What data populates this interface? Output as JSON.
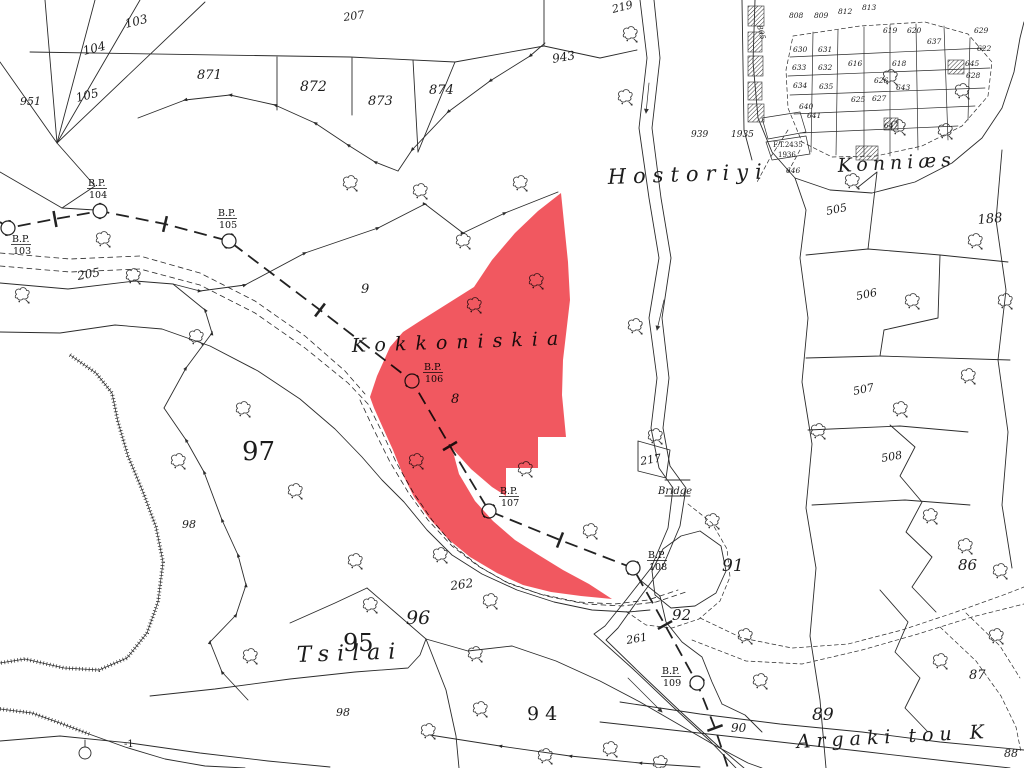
{
  "map": {
    "description": "cadastral survey map with red highlighted parcel",
    "ink_color": "#2b2b2b",
    "highlight_color": "#ef3b44",
    "highlighted_parcel": {
      "name": "Kokkoniskia highlighted parcel",
      "number": "8",
      "points": "561,193 568,262 570,300 563,360 562,395 566,437 538,437 538,468 506,468 506,496 492,487 471,469 452,448 459,474 475,501 493,521 515,540 537,554 563,570 589,584 612,599 581,596 551,592 523,585 497,573 470,557 448,539 429,518 414,497 403,475 393,450 383,428 374,408 370,397 377,376 390,347 403,332 420,321 447,304 474,287 492,260 515,233 538,211"
    },
    "labels": [
      {
        "t": "Hostoriyi",
        "x": 608,
        "y": 184,
        "s": 21,
        "ls": 7,
        "r": -2,
        "i": 1
      },
      {
        "t": "Konniæs",
        "x": 838,
        "y": 172,
        "s": 19,
        "ls": 5,
        "r": -3,
        "i": 1
      },
      {
        "t": "Kokkoniskia",
        "x": 352,
        "y": 352,
        "s": 19,
        "ls": 9,
        "r": -2,
        "i": 1
      },
      {
        "t": "Tsilai",
        "x": 297,
        "y": 662,
        "s": 22,
        "ls": 8,
        "r": -2,
        "i": 1
      },
      {
        "t": "Argaki tou K",
        "x": 797,
        "y": 748,
        "s": 19,
        "ls": 6,
        "r": -3,
        "i": 1
      },
      {
        "t": "103",
        "x": 126,
        "y": 28,
        "s": 12,
        "r": -14,
        "i": 1
      },
      {
        "t": "104",
        "x": 84,
        "y": 55,
        "s": 12,
        "r": -14,
        "i": 1
      },
      {
        "t": "105",
        "x": 77,
        "y": 102,
        "s": 12,
        "r": -14,
        "i": 1
      },
      {
        "t": "951",
        "x": 20,
        "y": 105,
        "s": 11,
        "r": 0,
        "i": 1
      },
      {
        "t": "871",
        "x": 197,
        "y": 79,
        "s": 13,
        "r": 0,
        "i": 1
      },
      {
        "t": "872",
        "x": 300,
        "y": 91,
        "s": 14,
        "r": 0,
        "i": 1
      },
      {
        "t": "873",
        "x": 368,
        "y": 105,
        "s": 13,
        "r": 0,
        "i": 1
      },
      {
        "t": "874",
        "x": 429,
        "y": 94,
        "s": 13,
        "r": 0,
        "i": 1
      },
      {
        "t": "207",
        "x": 344,
        "y": 21,
        "s": 11,
        "r": -8,
        "i": 1
      },
      {
        "t": "219",
        "x": 613,
        "y": 13,
        "s": 11,
        "r": -14,
        "i": 1
      },
      {
        "t": "943",
        "x": 553,
        "y": 63,
        "s": 12,
        "r": -10,
        "i": 1
      },
      {
        "t": "9",
        "x": 361,
        "y": 293,
        "s": 13,
        "r": 0,
        "i": 1
      },
      {
        "t": "8",
        "x": 451,
        "y": 403,
        "s": 13,
        "r": 0,
        "i": 1
      },
      {
        "t": "97",
        "x": 242,
        "y": 460,
        "s": 26,
        "r": 0
      },
      {
        "t": "98",
        "x": 182,
        "y": 528,
        "s": 11,
        "r": 0,
        "i": 1
      },
      {
        "t": "96",
        "x": 406,
        "y": 624,
        "s": 19,
        "r": 0,
        "i": 1
      },
      {
        "t": "95",
        "x": 343,
        "y": 651,
        "s": 24,
        "r": 0
      },
      {
        "t": "98",
        "x": 336,
        "y": 716,
        "s": 11,
        "r": 0,
        "i": 1
      },
      {
        "t": "94",
        "x": 527,
        "y": 720,
        "s": 19,
        "ls": 6,
        "r": 0
      },
      {
        "t": "91",
        "x": 722,
        "y": 571,
        "s": 17,
        "r": 0,
        "i": 1
      },
      {
        "t": "92",
        "x": 672,
        "y": 620,
        "s": 15,
        "r": 0,
        "i": 1
      },
      {
        "t": "90",
        "x": 731,
        "y": 732,
        "s": 12,
        "r": 0,
        "i": 1
      },
      {
        "t": "89",
        "x": 812,
        "y": 720,
        "s": 17,
        "r": 0,
        "i": 1
      },
      {
        "t": "86",
        "x": 958,
        "y": 570,
        "s": 15,
        "r": 0,
        "i": 1
      },
      {
        "t": "87",
        "x": 969,
        "y": 679,
        "s": 13,
        "r": 0,
        "i": 1
      },
      {
        "t": "88",
        "x": 1004,
        "y": 757,
        "s": 11,
        "r": 0,
        "i": 1
      },
      {
        "t": "217",
        "x": 641,
        "y": 465,
        "s": 11,
        "r": -10,
        "i": 1
      },
      {
        "t": "505",
        "x": 827,
        "y": 215,
        "s": 11,
        "r": -12,
        "i": 1
      },
      {
        "t": "506",
        "x": 857,
        "y": 300,
        "s": 11,
        "r": -12,
        "i": 1
      },
      {
        "t": "507",
        "x": 854,
        "y": 395,
        "s": 11,
        "r": -12,
        "i": 1
      },
      {
        "t": "508",
        "x": 882,
        "y": 462,
        "s": 11,
        "r": -10,
        "i": 1
      },
      {
        "t": "188",
        "x": 978,
        "y": 224,
        "s": 13,
        "r": -5,
        "i": 1
      },
      {
        "t": "262",
        "x": 451,
        "y": 590,
        "s": 12,
        "r": -8,
        "i": 1
      },
      {
        "t": "261",
        "x": 627,
        "y": 644,
        "s": 11,
        "r": -10,
        "i": 1
      },
      {
        "t": "205",
        "x": 78,
        "y": 280,
        "s": 12,
        "r": -10,
        "i": 1
      },
      {
        "t": "-1",
        "x": 124,
        "y": 747,
        "s": 10,
        "r": 0
      },
      {
        "t": "939",
        "x": 691,
        "y": 137,
        "s": 9,
        "r": 0,
        "i": 1
      },
      {
        "t": "1935",
        "x": 731,
        "y": 137,
        "s": 9,
        "r": 0,
        "i": 1
      },
      {
        "t": "F.T.2435",
        "x": 773,
        "y": 147,
        "s": 7,
        "r": 0
      },
      {
        "t": "1936",
        "x": 778,
        "y": 157,
        "s": 7,
        "r": 0
      },
      {
        "t": "Bridge",
        "x": 658,
        "y": 494,
        "s": 10,
        "r": 0,
        "i": 1
      }
    ],
    "village_numbers": [
      {
        "t": "805",
        "x": 757,
        "y": 26,
        "r": 75
      },
      {
        "t": "808",
        "x": 789,
        "y": 18
      },
      {
        "t": "809",
        "x": 814,
        "y": 18
      },
      {
        "t": "812",
        "x": 838,
        "y": 14
      },
      {
        "t": "813",
        "x": 862,
        "y": 10
      },
      {
        "t": "619",
        "x": 883,
        "y": 33
      },
      {
        "t": "620",
        "x": 907,
        "y": 33
      },
      {
        "t": "637",
        "x": 927,
        "y": 44
      },
      {
        "t": "629",
        "x": 974,
        "y": 33
      },
      {
        "t": "622",
        "x": 977,
        "y": 51
      },
      {
        "t": "630",
        "x": 793,
        "y": 52
      },
      {
        "t": "631",
        "x": 818,
        "y": 52
      },
      {
        "t": "633",
        "x": 792,
        "y": 70
      },
      {
        "t": "632",
        "x": 818,
        "y": 70
      },
      {
        "t": "634",
        "x": 793,
        "y": 88
      },
      {
        "t": "635",
        "x": 819,
        "y": 89
      },
      {
        "t": "640",
        "x": 799,
        "y": 109
      },
      {
        "t": "641",
        "x": 807,
        "y": 118
      },
      {
        "t": "616",
        "x": 848,
        "y": 66
      },
      {
        "t": "618",
        "x": 892,
        "y": 66
      },
      {
        "t": "626",
        "x": 874,
        "y": 83
      },
      {
        "t": "625",
        "x": 851,
        "y": 102
      },
      {
        "t": "627",
        "x": 872,
        "y": 101
      },
      {
        "t": "643",
        "x": 896,
        "y": 90
      },
      {
        "t": "645",
        "x": 965,
        "y": 66
      },
      {
        "t": "628",
        "x": 966,
        "y": 78
      },
      {
        "t": "646",
        "x": 786,
        "y": 173
      },
      {
        "t": "647",
        "x": 884,
        "y": 128
      }
    ],
    "bp_markers": [
      {
        "label": "B.P.",
        "number": "103",
        "cx": 8,
        "cy": 228,
        "lx": 12,
        "ly": 242
      },
      {
        "label": "B.P.",
        "number": "104",
        "cx": 100,
        "cy": 211,
        "lx": 88,
        "ly": 186
      },
      {
        "label": "B.P.",
        "number": "105",
        "cx": 229,
        "cy": 241,
        "lx": 218,
        "ly": 216
      },
      {
        "label": "B.P.",
        "number": "106",
        "cx": 412,
        "cy": 381,
        "lx": 424,
        "ly": 370
      },
      {
        "label": "B.P.",
        "number": "107",
        "cx": 489,
        "cy": 511,
        "lx": 500,
        "ly": 494
      },
      {
        "label": "B.P.",
        "number": "108",
        "cx": 633,
        "cy": 568,
        "lx": 648,
        "ly": 558
      },
      {
        "label": "B.P.",
        "number": "109",
        "cx": 697,
        "cy": 683,
        "lx": 662,
        "ly": 674
      }
    ],
    "symbols": {
      "trees": [
        [
          350,
          184
        ],
        [
          420,
          192
        ],
        [
          520,
          184
        ],
        [
          463,
          242
        ],
        [
          630,
          35
        ],
        [
          625,
          98
        ],
        [
          103,
          240
        ],
        [
          22,
          296
        ],
        [
          133,
          277
        ],
        [
          196,
          338
        ],
        [
          178,
          462
        ],
        [
          243,
          410
        ],
        [
          295,
          492
        ],
        [
          355,
          562
        ],
        [
          440,
          556
        ],
        [
          490,
          602
        ],
        [
          475,
          655
        ],
        [
          250,
          657
        ],
        [
          480,
          710
        ],
        [
          545,
          757
        ],
        [
          610,
          750
        ],
        [
          525,
          470
        ],
        [
          474,
          306
        ],
        [
          536,
          282
        ],
        [
          416,
          462
        ],
        [
          635,
          327
        ],
        [
          655,
          437
        ],
        [
          712,
          522
        ],
        [
          745,
          637
        ],
        [
          818,
          432
        ],
        [
          890,
          78
        ],
        [
          962,
          92
        ],
        [
          945,
          132
        ],
        [
          852,
          182
        ],
        [
          912,
          302
        ],
        [
          968,
          377
        ],
        [
          900,
          410
        ],
        [
          930,
          517
        ],
        [
          965,
          547
        ],
        [
          1000,
          572
        ],
        [
          996,
          637
        ],
        [
          940,
          662
        ],
        [
          760,
          682
        ],
        [
          590,
          532
        ],
        [
          975,
          242
        ],
        [
          1005,
          302
        ],
        [
          898,
          128
        ],
        [
          428,
          732
        ],
        [
          660,
          764
        ],
        [
          370,
          606
        ]
      ]
    }
  }
}
